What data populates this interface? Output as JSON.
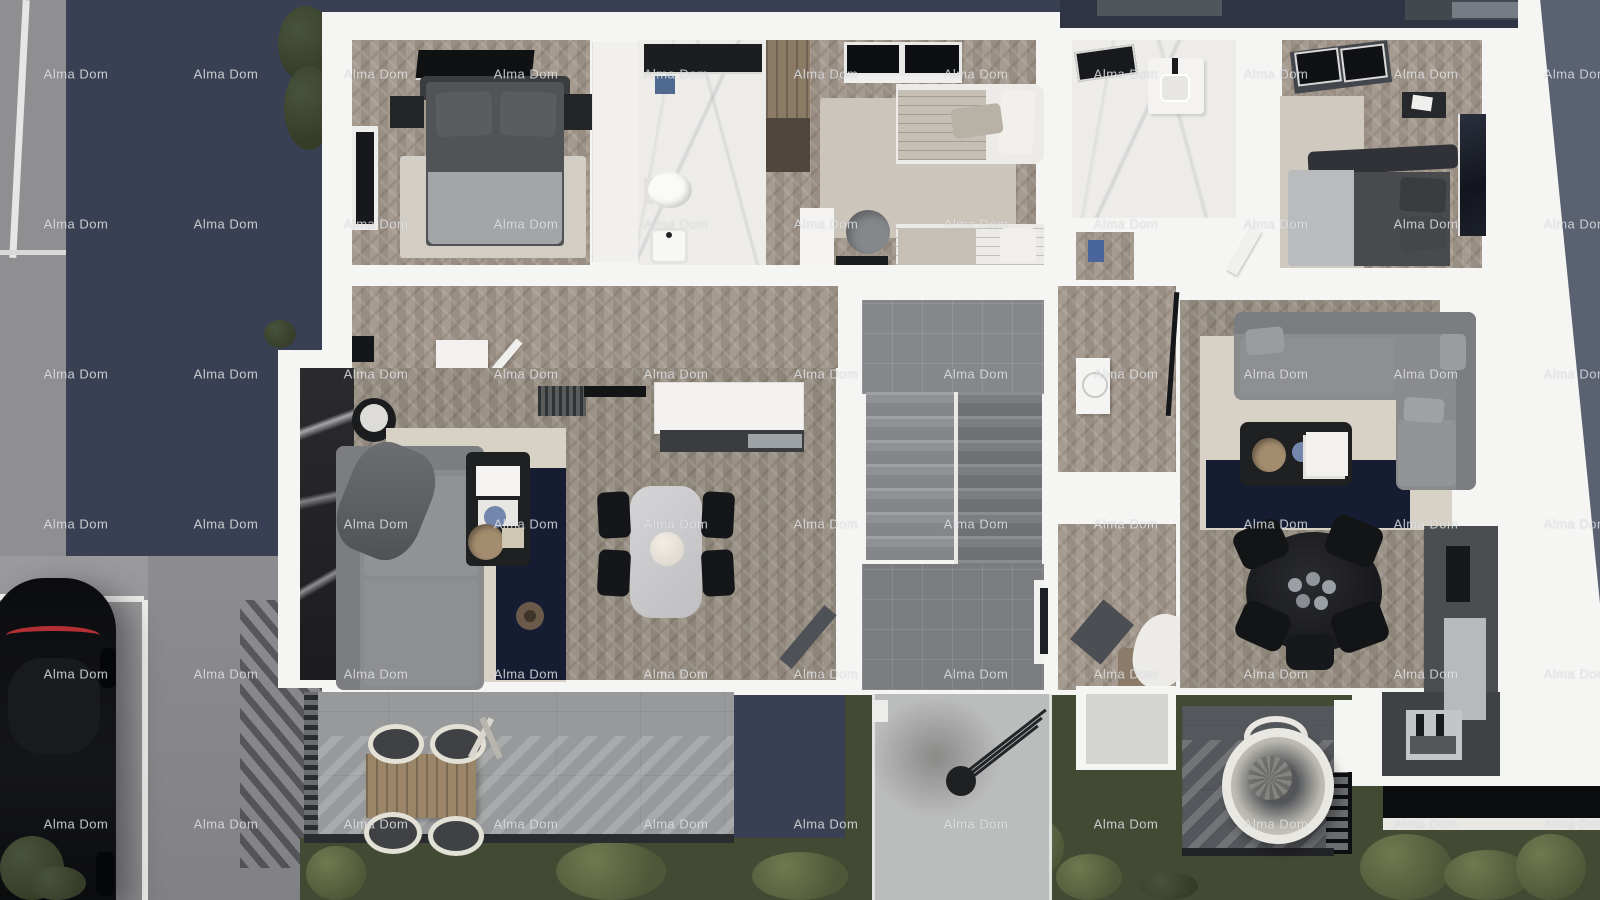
{
  "image_type": "top-down 3D architectural floor plan rendering of an apartment level with surroundings",
  "watermark": {
    "text": "Alma Dom",
    "color": "rgba(236,238,241,0.78)",
    "font_size_px": 13,
    "grid": {
      "cols": [
        76,
        226,
        376,
        526,
        676,
        826,
        976,
        1126,
        1276,
        1426,
        1576
      ],
      "rows": [
        74,
        224,
        374,
        524,
        674,
        824
      ]
    }
  },
  "palette": {
    "navy": "#3A4053",
    "top_navy": "#2E3443",
    "blue_gray": "#5A6170",
    "sidewalk": "#8F8F91",
    "parking": "#96969A",
    "wall": "#F5F5F3",
    "wood": "#A1968A",
    "marble": "#EDECE9",
    "marble_wall": "#232324",
    "stair_tile": "#85878B",
    "stair_tile_dark": "#7A7C80",
    "grass": "#434A33",
    "navy_rug": "#161D33",
    "beige_rug": "#D8D1C6",
    "sofa": "#8A8B8D",
    "sofa_dark": "#7C7D80",
    "charcoal": "#1F2021",
    "near_black": "#0C0D0E",
    "terrace": "#97999A",
    "deck": "#54575B",
    "walkway": "#BBBCBC",
    "outdoor_table": "#9A8568",
    "cream": "#E9E7E1",
    "steel": "#9EA3A8",
    "tail_red": "#B23034",
    "accent_blue": "#4E6890",
    "gold": "#A48D6F",
    "wm_color": "rgba(236,238,241,0.78)"
  },
  "scene": {
    "environment": [
      "navy driveway",
      "gray sidewalk with white curb line",
      "parking area with white markings",
      "black parked car",
      "dark lawn with shrubs",
      "concrete entrance walkway",
      "street lamp"
    ],
    "building": {
      "left_apartment": [
        "bedroom with double bed and TV",
        "en-suite bathroom with shower",
        "children bedroom with two beds, desk and wardrobe",
        "hallway",
        "open living room with kitchen, sectional sofa and dining table",
        "terrace with outdoor dining set"
      ],
      "shared": [
        "central staircase with two flights and lower landing"
      ],
      "right_apartment": [
        "bathroom with skylight and vanity",
        "bedroom with double bed, skylight and wall art",
        "entry hallway with washing machine and bench",
        "open living room with corner sofa, round dining table and kitchen",
        "balcony with hanging egg chair"
      ]
    }
  }
}
